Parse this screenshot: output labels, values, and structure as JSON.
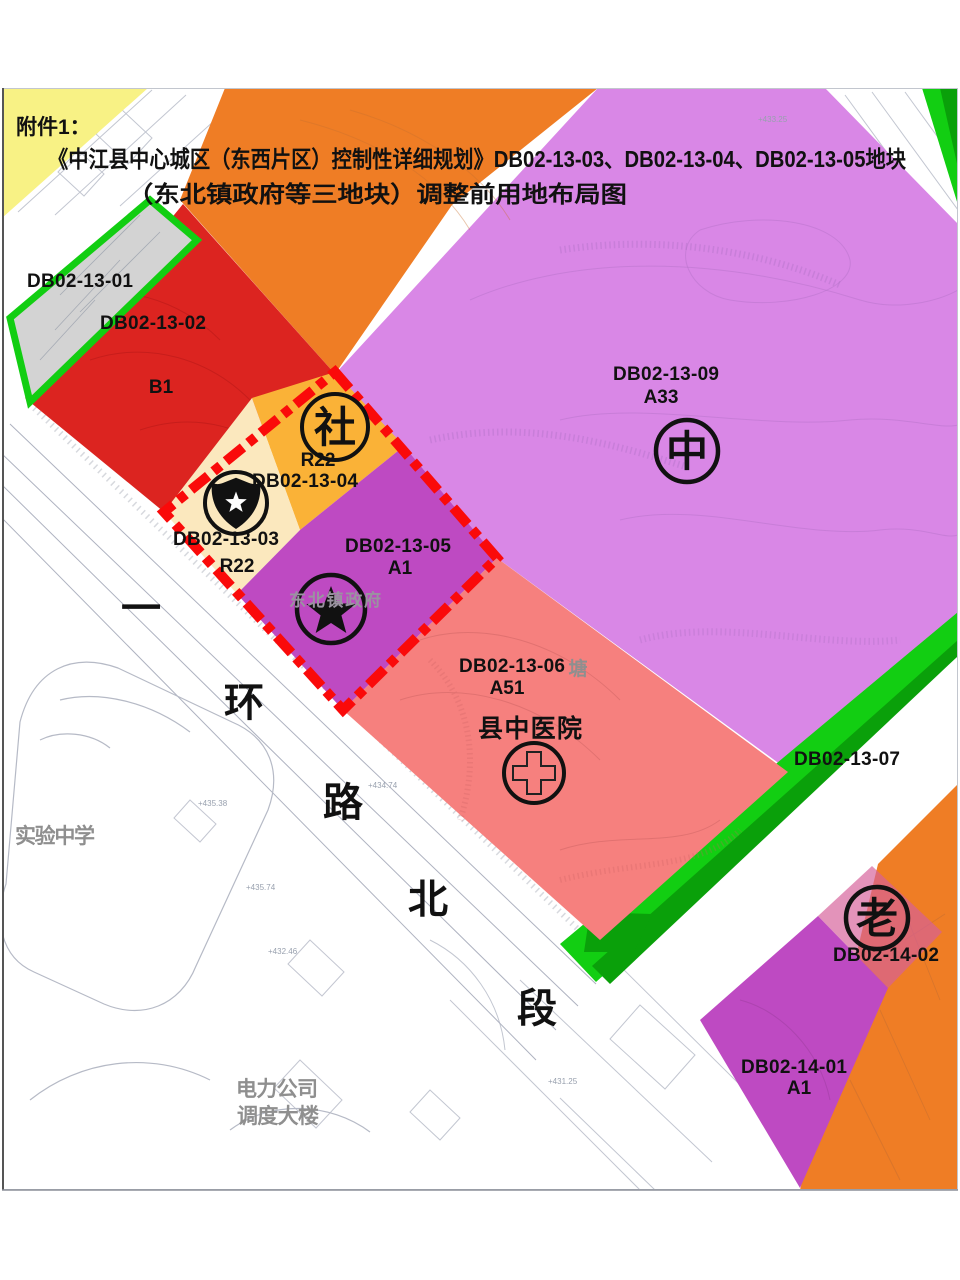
{
  "title": {
    "attachment": "附件1：",
    "line1": "《中江县中心城区（东西片区）控制性详细规划》DB02-13-03、DB02-13-04、DB02-13-05地块",
    "line2": "（东北镇政府等三地块）调整前用地布局图"
  },
  "colors": {
    "orange": "#EF7D25",
    "light_purple": "#D987E6",
    "magenta": "#BE4AC2",
    "red": "#DC2420",
    "amber": "#FAB237",
    "cream": "#FBE8BE",
    "salmon": "#F6807E",
    "rose": "#D6609A",
    "yellow": "#F8F285",
    "gray_parcel": "#D3D3D3",
    "green_bright": "#12CE12",
    "green_dark": "#0AA00A",
    "boundary_red": "#FA0A0A",
    "line_gray": "#B9BDC9",
    "text_gray": "#8F8F8F",
    "symbol_black": "#111111"
  },
  "parcels": [
    {
      "code": "DB02-13-01",
      "land_use": ""
    },
    {
      "code": "DB02-13-02",
      "land_use": "B1"
    },
    {
      "code": "DB02-13-03",
      "land_use": "R22"
    },
    {
      "code": "DB02-13-04",
      "land_use": "R22"
    },
    {
      "code": "DB02-13-05",
      "land_use": "A1",
      "name": "东北镇政府"
    },
    {
      "code": "DB02-13-06",
      "land_use": "A51",
      "name": "县中医院"
    },
    {
      "code": "DB02-13-07",
      "land_use": ""
    },
    {
      "code": "DB02-13-09",
      "land_use": "A33"
    },
    {
      "code": "DB02-14-01",
      "land_use": "A1"
    },
    {
      "code": "DB02-14-02",
      "land_use": ""
    }
  ],
  "symbols": {
    "community": "社",
    "middle_school": "中",
    "elderly": "老"
  },
  "road": {
    "chars": [
      "一",
      "环",
      "路",
      "北",
      "段"
    ]
  },
  "landmarks": {
    "school": "实验中学",
    "power_company_line1": "电力公司",
    "power_company_line2": "调度大楼",
    "pond": "塘"
  },
  "spot_elevations": [
    "+435.38",
    "+435.74",
    "+432.46",
    "+434.74",
    "+433.25",
    "+431.25"
  ]
}
